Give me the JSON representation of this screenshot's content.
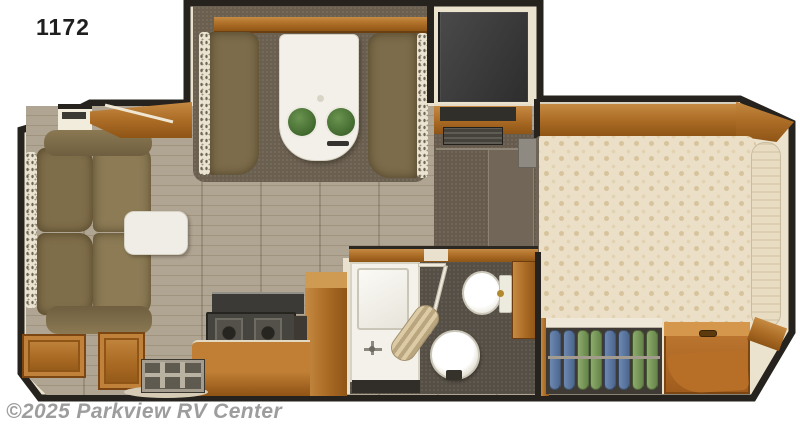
{
  "title": "1172",
  "watermark": "©2025 Parkview RV Center",
  "floorplan": {
    "type": "truck-camper-floorplan",
    "areas": [
      "dinette-slideout",
      "kitchen",
      "bathroom",
      "living-sofa",
      "bedroom",
      "entry"
    ],
    "furniture": [
      "sofa",
      "side-table",
      "dinette-benches",
      "dinette-table",
      "stools",
      "refrigerator",
      "stove",
      "kitchen-counter",
      "shower",
      "sink",
      "toilet",
      "bed",
      "wardrobe",
      "storage-chest",
      "entry-step",
      "overhead-cabinets"
    ],
    "stool_count": 2,
    "burner_count": 2
  },
  "wardrobe": {
    "shirts": [
      "blue",
      "blue",
      "green",
      "green",
      "blue",
      "blue",
      "green",
      "green"
    ]
  },
  "palette": {
    "wall": "#26231e",
    "interior": "#ece3cf",
    "wood": "#b5772f",
    "carpet": "#6b5f50",
    "floor_plank": "#aca08c",
    "sofa": "#84734f",
    "table_white": "#f2f0e8",
    "stool_green": "#4e7b38",
    "bed_cream": "#ebe0c7",
    "fridge_dark": "#3a3a3a",
    "shirt_blue": "#5c79a3",
    "shirt_green": "#7d9c5e",
    "watermark_gray": "#9d9d9d"
  }
}
